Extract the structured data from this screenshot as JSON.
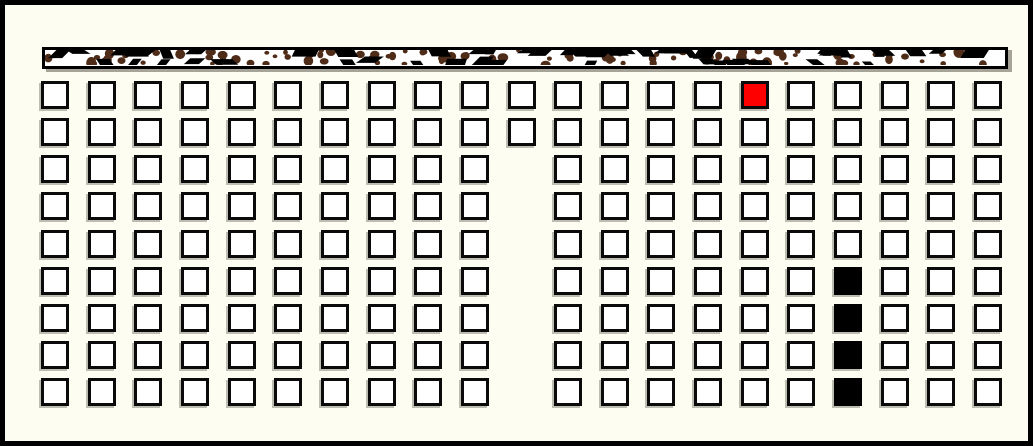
{
  "canvas": {
    "background_color": "#fdfdf1",
    "border_color": "#000000"
  },
  "top_bar": {
    "description": "speckled-texture-bar",
    "fill_color": "#ffffff",
    "border_color": "#000000",
    "speckle_dot_color": "#4f2c18",
    "speckle_dash_color": "#000000"
  },
  "grid": {
    "rows": 9,
    "cols": 21,
    "cell_fill_color": "#ffffff",
    "cell_border_color": "#000000",
    "red_color": "#ff0000",
    "black_color": "#000000",
    "missing_cells": [
      {
        "row": 2,
        "col": 10
      },
      {
        "row": 3,
        "col": 10
      },
      {
        "row": 4,
        "col": 10
      },
      {
        "row": 5,
        "col": 10
      },
      {
        "row": 6,
        "col": 10
      },
      {
        "row": 7,
        "col": 10
      },
      {
        "row": 8,
        "col": 10
      }
    ],
    "red_cells": [
      {
        "row": 0,
        "col": 15
      }
    ],
    "black_cells": [
      {
        "row": 5,
        "col": 17
      },
      {
        "row": 6,
        "col": 17
      },
      {
        "row": 7,
        "col": 17
      },
      {
        "row": 8,
        "col": 17
      }
    ]
  }
}
